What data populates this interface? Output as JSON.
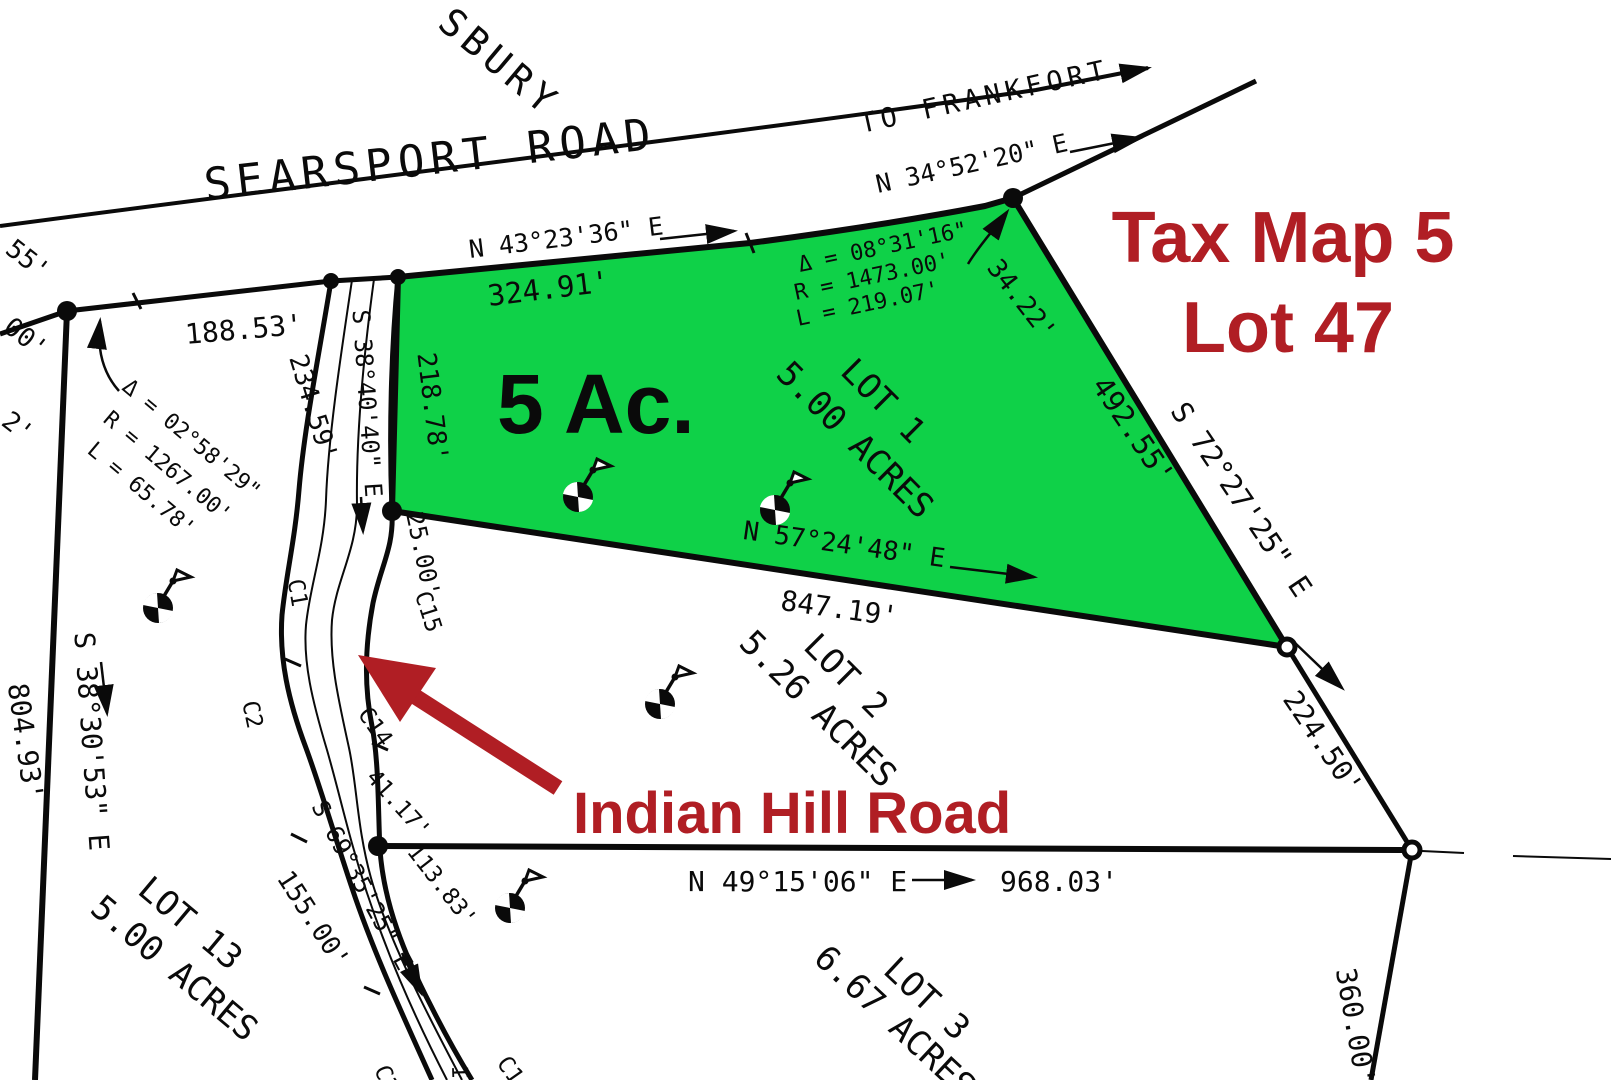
{
  "colors": {
    "lot1_fill": "#0fd148",
    "overlay_red": "#b01e24",
    "line_black": "#0a0a0a",
    "background": "#ffffff"
  },
  "overlay": {
    "tax_line1": "Tax Map 5",
    "tax_line2": "Lot 47",
    "road_callout": "Indian Hill Road",
    "acreage": "5 Ac."
  },
  "roads": {
    "searsport": "SEARSPORT ROAD",
    "to_frankfort": "TO FRANKFORT",
    "partial_top": "SBURY"
  },
  "bearings": {
    "searsport_east": "N 34°52'20\" E",
    "lot1_road_frontage": "N 43°23'36\" E",
    "indian_hill_upper": "S 38°40'40\" E",
    "lot1_south_line": "N 57°24'48\" E",
    "lot1_east_line": "S 72°27'25\" E",
    "west_boundary": "S 38°30'53\" E",
    "indian_hill_lower": "S 69°35'25\" E",
    "south_boundary": "N 49°15'06\" E"
  },
  "distances": {
    "lot1_road_frontage": "324.91'",
    "lot1_west_upper": "218.78'",
    "lot1_road_short": "34.22'",
    "lot1_east_line": "492.55'",
    "lot1_south_line": "847.19'",
    "searsport_frontage_west": "188.53'",
    "indian_hill_west": "234.59'",
    "lot1_west_lower": "25.00'",
    "lot2_east_line": "224.50'",
    "west_boundary": "804.93'",
    "south_boundary": "968.03'",
    "road_segment_a": "41.17'",
    "road_segment_b": "113.83'",
    "road_segment_c": "155.00'",
    "lot3_east_line": "360.00'"
  },
  "curves": {
    "c1": {
      "delta": "Δ = 08°31'16\"",
      "radius": "R = 1473.00'",
      "length": "L = 219.07'"
    },
    "c2": {
      "delta": "Δ = 02°58'29\"",
      "radius": "R = 1267.00'",
      "length": "L = 65.78'"
    }
  },
  "curve_refs": {
    "c1": "C1",
    "c2": "C2",
    "c14": "C14",
    "c15": "C15",
    "partial_a": "C3",
    "partial_b": "C1",
    "partial_in": "IN"
  },
  "lots": {
    "lot1": {
      "name": "LOT 1",
      "acres": "5.00 ACRES"
    },
    "lot2": {
      "name": "LOT 2",
      "acres": "5.26 ACRES"
    },
    "lot3": {
      "name": "LOT 3",
      "acres": "6.67 ACRES"
    },
    "lot13": {
      "name": "LOT 13",
      "acres": "5.00 ACRES"
    }
  },
  "partials": {
    "edge_a": "55'",
    "edge_b": "00'",
    "edge_c": "2'"
  }
}
